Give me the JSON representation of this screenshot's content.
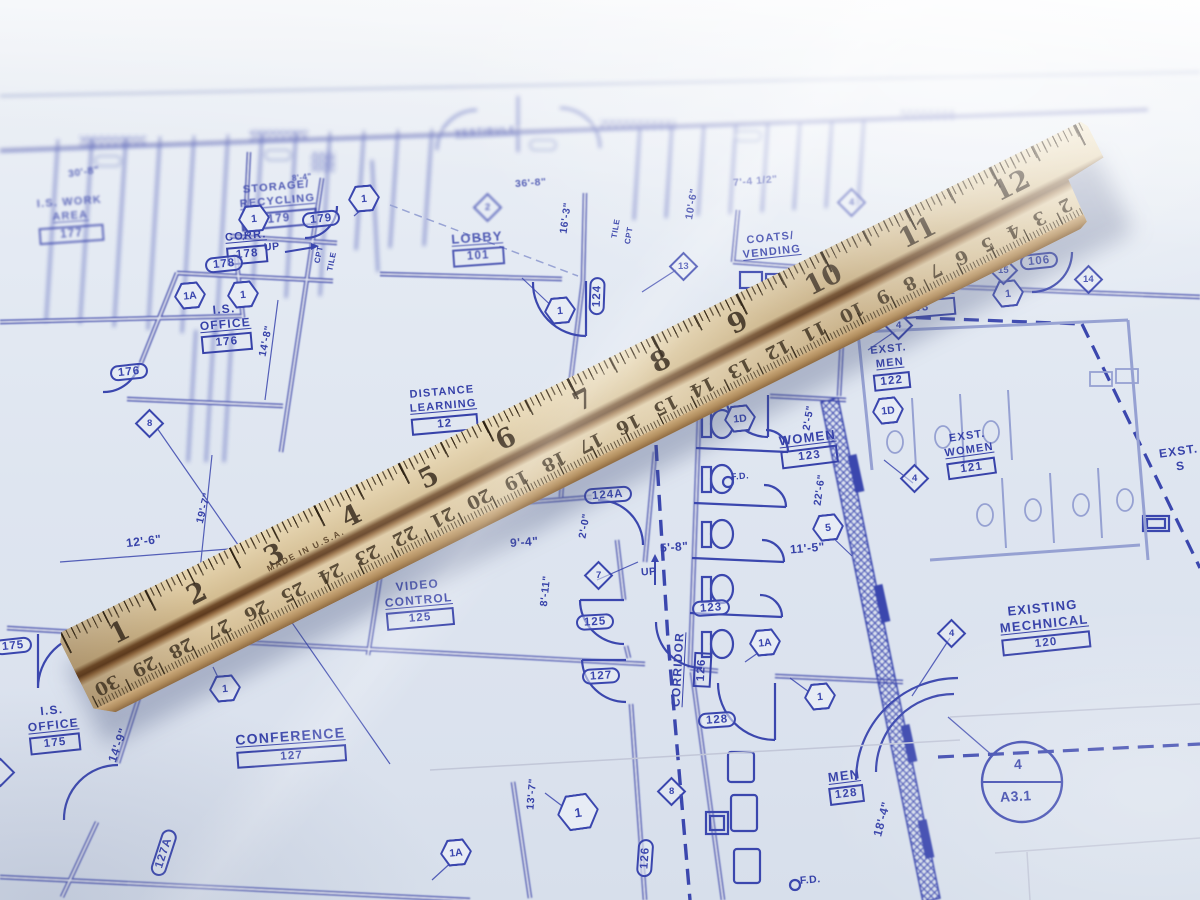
{
  "labels": {
    "work_area": {
      "l1": "I.S. WORK",
      "l2": "AREA",
      "num": "177"
    },
    "storage": {
      "l1": "STORAGE/",
      "l2": "RECYCLING",
      "num": "179"
    },
    "corr178": {
      "l1": "CORR.",
      "num": "178"
    },
    "office176": {
      "l1": "I.S.",
      "l2": "OFFICE",
      "num": "176"
    },
    "vestibule": {
      "l1": "VESTIBULE"
    },
    "lobby": {
      "l1": "LOBBY",
      "num": "101"
    },
    "coats": {
      "l1": "COATS/",
      "l2": "VENDING"
    },
    "corridor103": {
      "l1": "CORRIDOR",
      "num": "103"
    },
    "exst_men": {
      "l1": "EXST.",
      "l2": "MEN",
      "num": "122"
    },
    "exst_women": {
      "l1": "EXST.",
      "l2": "WOMEN",
      "num": "121"
    },
    "distance": {
      "l1": "DISTANCE",
      "l2": "LEARNING",
      "num": "12"
    },
    "video": {
      "l1": "VIDEO",
      "l2": "CONTROL",
      "num": "125"
    },
    "women": {
      "l1": "WOMEN",
      "num": "123"
    },
    "conference": {
      "l1": "CONFERENCE",
      "num": "127"
    },
    "corridor126": {
      "l1": "CORRIDOR",
      "num": "126"
    },
    "men": {
      "l1": "MEN",
      "num": "128"
    },
    "mechanical": {
      "l1": "EXISTING",
      "l2": "MECHNICAL",
      "num": "120"
    },
    "office175": {
      "l1": "I.S.",
      "l2": "OFFICE",
      "num": "175"
    },
    "exst_edge": {
      "l1": "EXST.",
      "l2": "S"
    }
  },
  "door_tags": {
    "t175": "175",
    "t176": "176",
    "t178": "178",
    "t179": "179",
    "t123": "123",
    "t124": "124",
    "t124a": "124A",
    "t125": "125",
    "t126": "126",
    "t127": "127",
    "t127a": "127A",
    "t128": "128",
    "t106": "106",
    "t106a": "106A"
  },
  "keynotes": {
    "h1": "1",
    "h1a": "1A",
    "h1d": "1D",
    "h5": "5",
    "d2": "2",
    "d4": "4",
    "d7": "7",
    "d8": "8",
    "d13": "13",
    "d14": "14",
    "d15": "15"
  },
  "dims": {
    "d30_8": "30'-8\"",
    "d8_4": "8'-4\"",
    "d36_8": "36'-8\"",
    "d7_4": "7'-4 1/2\"",
    "d10_6": "10'-6\"",
    "d16_3": "16'-3\"",
    "d10_0": "10'-0\"",
    "d14_8": "14'-8\"",
    "d19_7": "19'-7\"",
    "d12_6": "12'-6\"",
    "d9_4": "9'-4\"",
    "d2_0": "2'-0\"",
    "d8_11": "8'-11\"",
    "d5_8": "5'-8\"",
    "d2_5": "2'-5\"",
    "d22_6": "22'-6\"",
    "d11_5": "11'-5\"",
    "d13_7": "13'-7\"",
    "d14_9": "14'-9\"",
    "d18_4": "18'-4\""
  },
  "annos": {
    "up": "UP",
    "fd": "F.D.",
    "tile": "TILE",
    "cpt": "CPT"
  },
  "callout": {
    "top": "4",
    "bot": "A3.1"
  },
  "ruler": {
    "made_in": "MADE IN U.S.A.",
    "inches": [
      "1",
      "2",
      "3",
      "4",
      "5",
      "6",
      "7",
      "8",
      "9",
      "10",
      "11",
      "12"
    ],
    "cm": [
      "30",
      "29",
      "28",
      "27",
      "26",
      "25",
      "24",
      "23",
      "22",
      "21",
      "20",
      "19",
      "18",
      "17",
      "16",
      "15",
      "14",
      "13",
      "12",
      "11",
      "10",
      "9",
      "8",
      "7",
      "6",
      "5",
      "4",
      "3",
      "2",
      "1"
    ]
  }
}
